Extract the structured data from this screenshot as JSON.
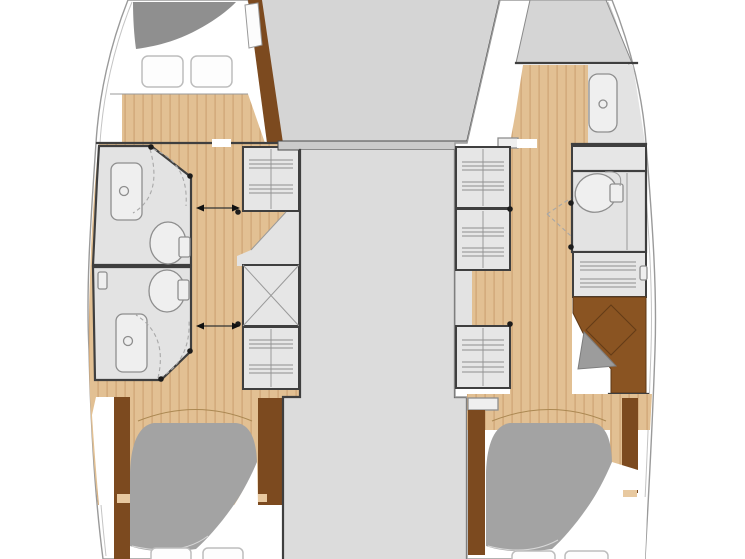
{
  "diagram": {
    "kind": "catamaran-lower-deck-floor-plan",
    "visible_text": [],
    "rooms": [
      "port-forward-cabin",
      "port-forward-bathroom",
      "port-aft-bathroom",
      "port-aft-cabin",
      "central-walkway",
      "starboard-forward-cabin",
      "starboard-shower-room",
      "starboard-toilet-room",
      "starboard-desk-area",
      "starboard-aft-cabin"
    ]
  },
  "colors": {
    "hull_fill": "#ffffff",
    "hull_stroke": "#9a9a9a",
    "deck_gray": "#d5d5d5",
    "corridor_gray": "#dcdcdc",
    "room_gray": "#e3e3e3",
    "furniture_gray": "#e6e6e6",
    "bow_dark_gray": "#8f8f8f",
    "bed_gray": "#a3a3a3",
    "wood": "#e2c093",
    "wood_plank_line": "#d1a878",
    "wood_dark": "#7c4a1f",
    "wood_cap": "#e8c9a0",
    "desk_brown": "#8a5422",
    "wall": "#3f3f3f",
    "fixture_fill": "#efefef",
    "fixture_stroke": "#8e8e8e",
    "stripe": "#8f8f8f",
    "dash": "#a8a8a8"
  }
}
